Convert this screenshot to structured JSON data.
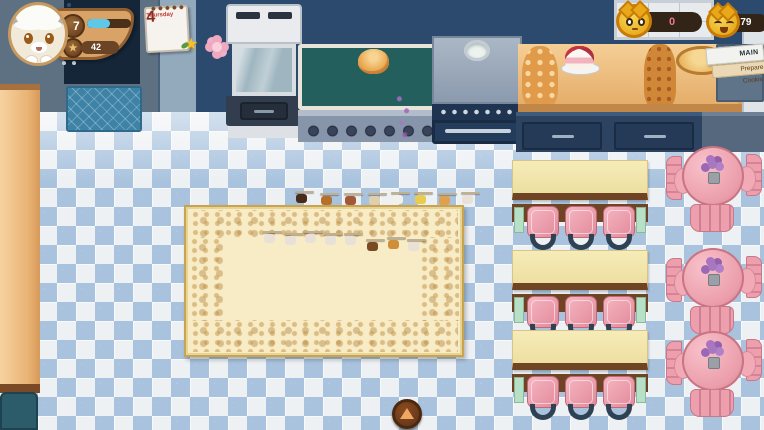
{
  "theme": {
    "wood_panel": "#d9a368",
    "xp_fill": "#5ec8e8",
    "coin_gold": "#f6c42e",
    "stool_pink": "#ee9fad",
    "floor_diamond": "#a9c3de",
    "icon_colors": {
      "chocolate": "#4a2a18",
      "pastry": "#b5702e",
      "meat": "#a05838",
      "bowl": "#e0cfae",
      "milk": "#f2f0ea",
      "butter": "#e8cc50",
      "croissant": "#dfa050",
      "cat": "#e9e1d7",
      "cookie": "#7a4a22",
      "caramel": "#cf8f3a"
    }
  },
  "hud": {
    "player": {
      "level": "7",
      "xp_percent": 52,
      "star_count": "42"
    },
    "calendar": {
      "weekday": "Thursday",
      "day": "4"
    },
    "calendar_icons": [
      "star-leaf-icon",
      "flower-icon"
    ],
    "currencies": [
      {
        "icon": "cat-coin-icon",
        "value": "0"
      },
      {
        "icon": "happy-cat-coin-icon",
        "value": "4.79"
      }
    ],
    "quest": {
      "title": "MAIN QUEST",
      "objective": "Prepare Cookie"
    }
  },
  "controls": {
    "expand_icon": "up-arrow-icon"
  },
  "kitchen": {
    "stations": [
      "coffee-machine",
      "croissant-display",
      "stove",
      "dessert-counter"
    ],
    "croissants": 8,
    "burners": 4,
    "desserts": {
      "strawberry_cakes": 4,
      "pancake_stacks": 2,
      "cream_puff_towers": 1,
      "caramel_towers": 1,
      "ice_cream_swirls": 1
    }
  },
  "board": {
    "cards": [
      {
        "x": 295,
        "y": 191,
        "header": "#7a2430",
        "icon": "chocolate"
      },
      {
        "x": 320,
        "y": 193,
        "header": "#8a42b0",
        "icon": "pastry"
      },
      {
        "x": 344,
        "y": 193,
        "header": "#8a42b0",
        "icon": "meat"
      },
      {
        "x": 368,
        "y": 193,
        "header": "#e09030",
        "icon": "bowl",
        "extra": true
      },
      {
        "x": 391,
        "y": 192,
        "header": "#62bd35",
        "icon": "milk"
      },
      {
        "x": 414,
        "y": 192,
        "header": "#b5a21e",
        "icon": "butter"
      },
      {
        "x": 438,
        "y": 193,
        "header": "#3a68d8",
        "icon": "croissant"
      },
      {
        "x": 461,
        "y": 192,
        "header": "#7a42b8",
        "bars": 3,
        "barColor": "#4a78e0",
        "icon": "cat"
      },
      {
        "x": 263,
        "y": 231,
        "header": "#c23535",
        "band": "#e0882e",
        "icon": "cat"
      },
      {
        "x": 284,
        "y": 233,
        "header": "#c23535",
        "band": "#e0882e",
        "icon": "cat"
      },
      {
        "x": 304,
        "y": 231,
        "header": "#c23535",
        "band": "#e0882e",
        "icon": "cat"
      },
      {
        "x": 324,
        "y": 233,
        "header": "#c23535",
        "band": "#e0882e",
        "icon": "cat"
      },
      {
        "x": 344,
        "y": 233,
        "header": "#c23535",
        "band": "#e0882e",
        "icon": "cat"
      },
      {
        "x": 366,
        "y": 239,
        "bars": 8,
        "barColor": "#b5851f",
        "icon": "cookie"
      },
      {
        "x": 387,
        "y": 237,
        "bars": 3,
        "barColor": "#b5851f",
        "icon": "caramel"
      },
      {
        "x": 407,
        "y": 239,
        "bars": 7,
        "barColor": "#b5851f",
        "icon": "cat"
      }
    ]
  },
  "dining": {
    "stools_per_table": 3,
    "bar_tables": [
      {
        "x": 512,
        "y": 160
      },
      {
        "x": 512,
        "y": 250
      },
      {
        "x": 512,
        "y": 330
      }
    ],
    "round_tables": [
      {
        "x": 666,
        "y": 146
      },
      {
        "x": 666,
        "y": 248
      },
      {
        "x": 666,
        "y": 331
      }
    ]
  }
}
